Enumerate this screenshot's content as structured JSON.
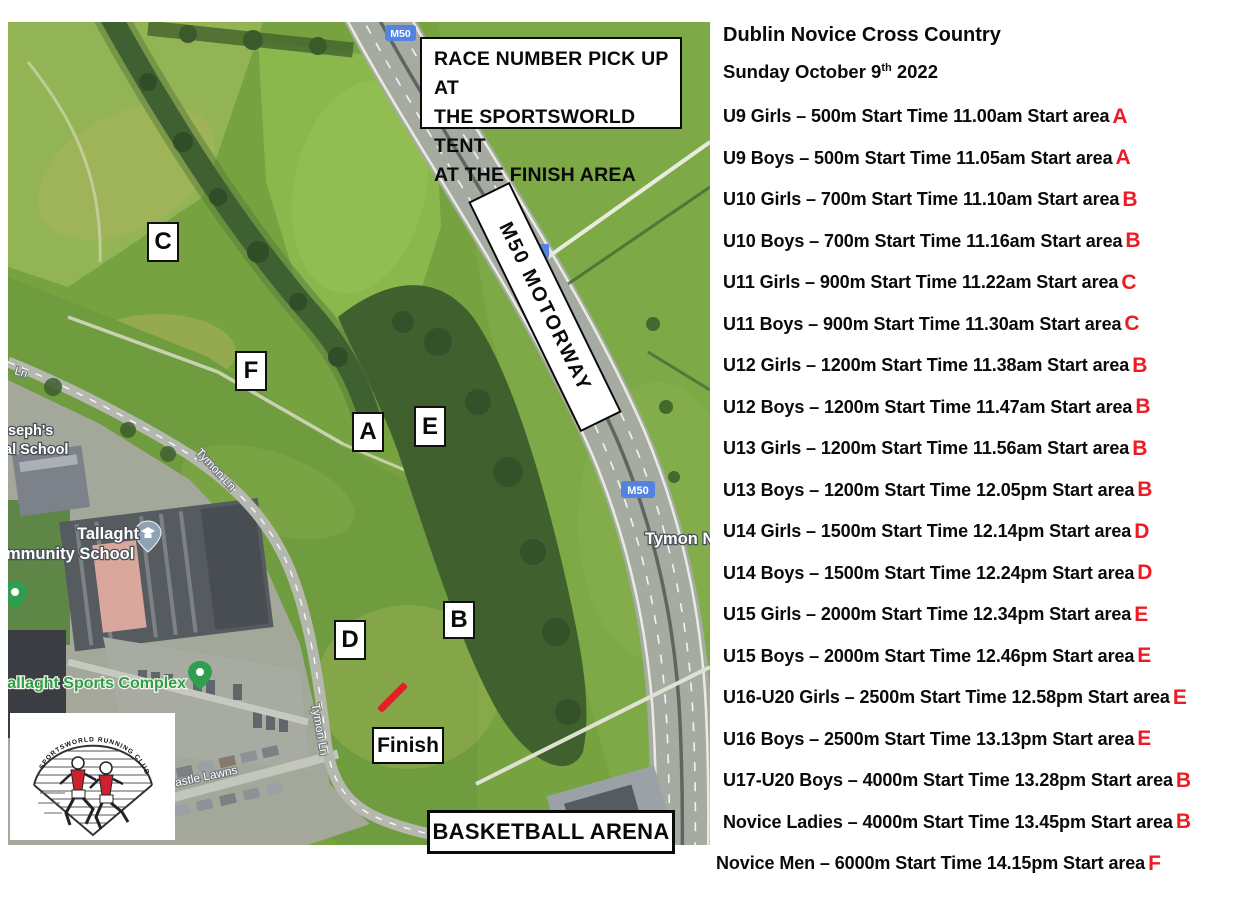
{
  "map": {
    "note_lines": [
      "RACE NUMBER PICK UP AT",
      "THE SPORTSWORLD TENT",
      "AT THE FINISH AREA"
    ],
    "motorway_label": "M50 MOTORWAY",
    "m50_shield": "M50",
    "markers": [
      "C",
      "F",
      "A",
      "E",
      "D",
      "B"
    ],
    "finish_label": "Finish",
    "arena_label": "BASKETBALL ARENA",
    "finish_line_color": "#e81e24",
    "places": {
      "school_line1": "Tallaght",
      "school_line2": "mmunity School",
      "sports_complex": "allaght Sports Complex",
      "josephs_line1": "seph's",
      "josephs_line2": "al School",
      "road_ln": "Ln",
      "tymon_ln_upper": "Tymon Ln",
      "tymon_ln_lower": "Tymon Ln",
      "castle_lawns": "astle Lawns",
      "tymon_n": "Tymon N"
    },
    "logo_arc_text": "SPORTSWORLD RUNNING CLUB"
  },
  "schedule": {
    "title": "Dublin Novice Cross Country",
    "date": {
      "pre": "Sunday October 9",
      "sup": "th",
      "post": " 2022"
    },
    "area_color": "#ed1c24",
    "rows": [
      {
        "text": "U9 Girls – 500m Start Time 11.00am Start area ",
        "area": "A"
      },
      {
        "text": "U9 Boys – 500m Start Time 11.05am Start area ",
        "area": "A"
      },
      {
        "text": "U10 Girls – 700m Start Time 11.10am Start area ",
        "area": "B"
      },
      {
        "text": "U10 Boys – 700m Start Time 11.16am Start area ",
        "area": "B"
      },
      {
        "text": "U11 Girls – 900m Start Time 11.22am Start area ",
        "area": "C"
      },
      {
        "text": "U11 Boys – 900m Start Time 11.30am Start area ",
        "area": "C"
      },
      {
        "text": "U12 Girls – 1200m Start Time 11.38am Start area ",
        "area": "B"
      },
      {
        "text": "U12 Boys – 1200m Start Time 11.47am Start area ",
        "area": "B"
      },
      {
        "text": "U13 Girls – 1200m Start Time 11.56am Start area ",
        "area": "B"
      },
      {
        "text": "U13 Boys – 1200m Start Time 12.05pm Start area ",
        "area": "B"
      },
      {
        "text": "U14 Girls – 1500m Start Time 12.14pm Start area ",
        "area": "D"
      },
      {
        "text": "U14 Boys – 1500m Start Time 12.24pm Start area ",
        "area": "D"
      },
      {
        "text": "U15 Girls – 2000m Start Time 12.34pm Start area ",
        "area": "E"
      },
      {
        "text": "U15 Boys – 2000m Start Time 12.46pm Start area ",
        "area": "E"
      },
      {
        "text": "U16-U20 Girls – 2500m Start Time 12.58pm Start area ",
        "area": "E"
      },
      {
        "text": "U16 Boys – 2500m Start Time 13.13pm Start area ",
        "area": "E"
      },
      {
        "text": "U17-U20 Boys – 4000m Start Time 13.28pm Start area ",
        "area": "B"
      },
      {
        "text": "Novice Ladies – 4000m Start Time 13.45pm Start area ",
        "area": "B"
      },
      {
        "text": "Novice Men – 6000m Start Time 14.15pm Start area ",
        "area": "F"
      }
    ]
  }
}
